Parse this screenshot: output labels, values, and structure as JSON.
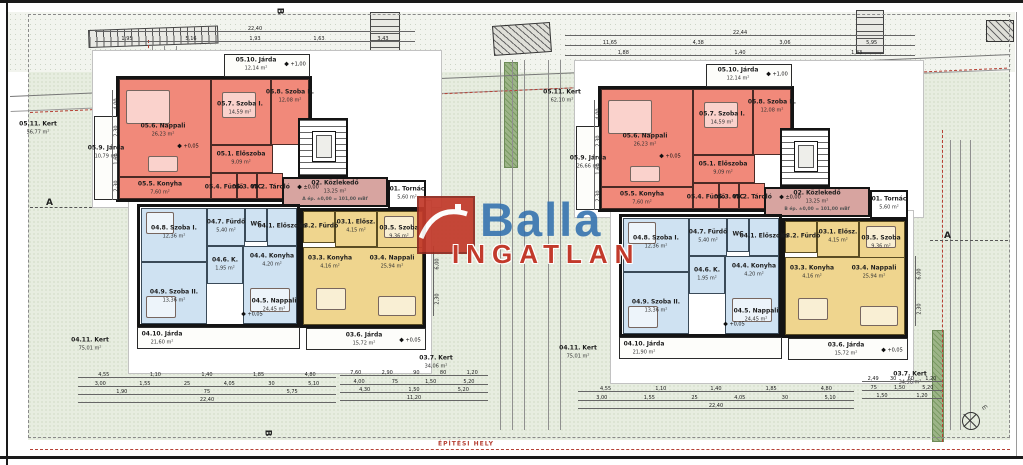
{
  "site_note": "ÉPÍTÉSI HELY",
  "logo": {
    "line1": "Balla",
    "line2": "INGATLAN",
    "blue": "#3270ae",
    "red": "#c23a2b",
    "icon": "house-roof-icon"
  },
  "markers": {
    "section_a": "A",
    "section_b": "B",
    "north": "m"
  },
  "plan": {
    "boxes": [
      {
        "n": "pad-upper",
        "cls": "pad",
        "x": 92,
        "y": 50,
        "w": 350,
        "h": 158
      },
      {
        "n": "pad-lower",
        "cls": "pad",
        "x": 128,
        "y": 200,
        "w": 304,
        "h": 174
      },
      {
        "n": "apartment-05-red",
        "cls": "apt",
        "x": 116,
        "y": 76,
        "w": 196,
        "h": 126
      },
      {
        "n": "room-nappali-05",
        "cls": "red",
        "x": 119,
        "y": 79,
        "w": 92,
        "h": 98
      },
      {
        "n": "room-szoba1-05",
        "cls": "red",
        "x": 211,
        "y": 79,
        "w": 60,
        "h": 66
      },
      {
        "n": "room-szoba2-05",
        "cls": "red",
        "x": 271,
        "y": 79,
        "w": 38,
        "h": 66
      },
      {
        "n": "room-eloszoba-05",
        "cls": "red",
        "x": 211,
        "y": 145,
        "w": 62,
        "h": 28
      },
      {
        "n": "room-furdo-05",
        "cls": "red",
        "x": 211,
        "y": 173,
        "w": 26,
        "h": 26
      },
      {
        "n": "room-wc-05",
        "cls": "red",
        "x": 237,
        "y": 173,
        "w": 20,
        "h": 26
      },
      {
        "n": "room-tarolo-05",
        "cls": "red",
        "x": 257,
        "y": 173,
        "w": 26,
        "h": 26
      },
      {
        "n": "room-konyha-05",
        "cls": "red",
        "x": 119,
        "y": 177,
        "w": 92,
        "h": 22
      },
      {
        "n": "jarda-05-10",
        "cls": "jarda",
        "x": 224,
        "y": 54,
        "w": 86,
        "h": 23
      },
      {
        "n": "jarda-05-9",
        "cls": "jarda",
        "x": 94,
        "y": 116,
        "w": 24,
        "h": 84
      },
      {
        "n": "stairwell",
        "cls": "stair",
        "x": 298,
        "y": 118,
        "w": 50,
        "h": 59
      },
      {
        "n": "elevator",
        "cls": "lift",
        "x": 312,
        "y": 131,
        "w": 24,
        "h": 31
      },
      {
        "n": "corridor-02",
        "cls": "pink",
        "x": 282,
        "y": 177,
        "w": 106,
        "h": 30
      },
      {
        "n": "tornac-01",
        "cls": "white-room",
        "x": 388,
        "y": 180,
        "w": 38,
        "h": 29
      },
      {
        "n": "apartment-04-blue",
        "cls": "apt",
        "x": 137,
        "y": 204,
        "w": 163,
        "h": 123
      },
      {
        "n": "room-szoba1-04",
        "cls": "blue",
        "x": 141,
        "y": 208,
        "w": 66,
        "h": 54
      },
      {
        "n": "room-furdo-04",
        "cls": "blue",
        "x": 207,
        "y": 208,
        "w": 38,
        "h": 38
      },
      {
        "n": "room-wc-04",
        "cls": "blue",
        "x": 245,
        "y": 208,
        "w": 22,
        "h": 34
      },
      {
        "n": "room-eloszoba-04",
        "cls": "blue",
        "x": 267,
        "y": 208,
        "w": 30,
        "h": 38
      },
      {
        "n": "room-kamra-04",
        "cls": "blue",
        "x": 207,
        "y": 246,
        "w": 36,
        "h": 38
      },
      {
        "n": "room-open-04",
        "cls": "blue",
        "x": 243,
        "y": 246,
        "w": 54,
        "h": 78
      },
      {
        "n": "room-szoba2-04",
        "cls": "blue",
        "x": 141,
        "y": 262,
        "w": 66,
        "h": 62
      },
      {
        "n": "jarda-04-10",
        "cls": "jarda",
        "x": 137,
        "y": 327,
        "w": 163,
        "h": 22
      },
      {
        "n": "apartment-03-yellow",
        "cls": "apt",
        "x": 300,
        "y": 208,
        "w": 126,
        "h": 120
      },
      {
        "n": "room-furdo-03",
        "cls": "yellow",
        "x": 303,
        "y": 211,
        "w": 32,
        "h": 32
      },
      {
        "n": "room-eloszoba-03",
        "cls": "yellow",
        "x": 335,
        "y": 211,
        "w": 42,
        "h": 36
      },
      {
        "n": "room-szoba-03",
        "cls": "yellow",
        "x": 377,
        "y": 211,
        "w": 46,
        "h": 48
      },
      {
        "n": "room-open-03",
        "cls": "yellow",
        "x": 303,
        "y": 247,
        "w": 120,
        "h": 78
      },
      {
        "n": "jarda-03-6",
        "cls": "jarda",
        "x": 306,
        "y": 328,
        "w": 120,
        "h": 22
      },
      {
        "n": "sofa",
        "cls": "furn",
        "x": 126,
        "y": 90,
        "w": 44,
        "h": 34
      },
      {
        "n": "bed",
        "cls": "furn",
        "x": 222,
        "y": 92,
        "w": 34,
        "h": 26
      },
      {
        "n": "table",
        "cls": "furn",
        "x": 148,
        "y": 156,
        "w": 30,
        "h": 16
      },
      {
        "n": "bed",
        "cls": "furn",
        "x": 146,
        "y": 212,
        "w": 28,
        "h": 22
      },
      {
        "n": "bed",
        "cls": "furn",
        "x": 146,
        "y": 296,
        "w": 30,
        "h": 22
      },
      {
        "n": "sofa",
        "cls": "furn",
        "x": 250,
        "y": 288,
        "w": 40,
        "h": 24
      },
      {
        "n": "table",
        "cls": "furn",
        "x": 316,
        "y": 288,
        "w": 30,
        "h": 22
      },
      {
        "n": "sofa",
        "cls": "furn",
        "x": 378,
        "y": 296,
        "w": 38,
        "h": 20
      },
      {
        "n": "bed",
        "cls": "furn",
        "x": 384,
        "y": 216,
        "w": 30,
        "h": 22
      }
    ],
    "labels": [
      {
        "code": "05.10.",
        "name": "Járda",
        "area": "12,14 m²",
        "x": 256,
        "y": 64
      },
      {
        "code": "05.11.",
        "name": "Kert",
        "area": "56,77 m²",
        "x": 38,
        "y": 128
      },
      {
        "code": "05.9.",
        "name": "Járda",
        "area": "10,79 m²",
        "x": 106,
        "y": 152
      },
      {
        "code": "05.6.",
        "name": "Nappali",
        "area": "26,23 m²",
        "x": 163,
        "y": 130
      },
      {
        "code": "05.7.",
        "name": "Szoba I.",
        "area": "14,59 m²",
        "x": 240,
        "y": 108
      },
      {
        "code": "05.8.",
        "name": "Szoba II.",
        "area": "12,08 m²",
        "x": 290,
        "y": 96
      },
      {
        "code": "05.1.",
        "name": "Előszoba",
        "area": "9,09 m²",
        "x": 241,
        "y": 158
      },
      {
        "code": "05.5.",
        "name": "Konyha",
        "area": "7,60 m²",
        "x": 160,
        "y": 188
      },
      {
        "code": "05.4.",
        "name": "Fürdő",
        "area": "",
        "x": 224,
        "y": 187
      },
      {
        "code": "05.3.",
        "name": "WC",
        "area": "",
        "x": 247,
        "y": 187
      },
      {
        "code": "05.2.",
        "name": "Tároló",
        "area": "",
        "x": 270,
        "y": 187
      },
      {
        "code": "02.",
        "name": "Közlekedő",
        "area": "13,25 m²",
        "x": 335,
        "y": 187
      },
      {
        "k": "elev",
        "code": "",
        "name": "",
        "area": "",
        "x": 335,
        "y": 200
      },
      {
        "code": "01.",
        "name": "Tornác",
        "area": "5,60 m²",
        "x": 407,
        "y": 193
      },
      {
        "code": "04.8.",
        "name": "Szoba I.",
        "area": "12,36 m²",
        "x": 174,
        "y": 232
      },
      {
        "code": "04.7.",
        "name": "Fürdő",
        "area": "5,40 m²",
        "x": 226,
        "y": 226
      },
      {
        "code": "",
        "name": "WC",
        "area": "",
        "x": 256,
        "y": 224
      },
      {
        "code": "04.1.",
        "name": "Előszoba",
        "area": "",
        "x": 282,
        "y": 226
      },
      {
        "code": "04.6.",
        "name": "K.",
        "area": "1,95 m²",
        "x": 225,
        "y": 264
      },
      {
        "code": "04.4.",
        "name": "Konyha",
        "area": "4,20 m²",
        "x": 272,
        "y": 260
      },
      {
        "code": "04.5.",
        "name": "Nappali",
        "area": "24,45 m²",
        "x": 274,
        "y": 305
      },
      {
        "code": "04.9.",
        "name": "Szoba II.",
        "area": "13,36 m²",
        "x": 174,
        "y": 296
      },
      {
        "code": "04.10.",
        "name": "Járda",
        "area": "21,60 m²",
        "x": 162,
        "y": 338
      },
      {
        "code": "04.11.",
        "name": "Kert",
        "area": "75,01 m²",
        "x": 90,
        "y": 344
      },
      {
        "code": "03.2.",
        "name": "Fürdő",
        "area": "",
        "x": 319,
        "y": 226
      },
      {
        "code": "03.1.",
        "name": "Elősz.",
        "area": "4,15 m²",
        "x": 356,
        "y": 226
      },
      {
        "code": "03.5.",
        "name": "Szoba",
        "area": "9,36 m²",
        "x": 399,
        "y": 232
      },
      {
        "code": "03.3.",
        "name": "Konyha",
        "area": "4,16 m²",
        "x": 330,
        "y": 262
      },
      {
        "code": "03.4.",
        "name": "Nappali",
        "area": "25,94 m²",
        "x": 392,
        "y": 262
      },
      {
        "code": "03.6.",
        "name": "Járda",
        "area": "15,72 m²",
        "x": 364,
        "y": 339
      },
      {
        "code": "03.7.",
        "name": "Kert",
        "area": "34,06 m²",
        "x": 436,
        "y": 362
      }
    ],
    "marks": [
      {
        "x": 188,
        "y": 146,
        "t": "+0,05"
      },
      {
        "x": 295,
        "y": 64,
        "t": "+1,00"
      },
      {
        "x": 308,
        "y": 187,
        "t": "±0,00"
      },
      {
        "x": 252,
        "y": 314,
        "t": "+0,05"
      },
      {
        "x": 410,
        "y": 340,
        "t": "+0,05"
      }
    ]
  },
  "buildings": [
    {
      "id": "A",
      "elev_note": "A ép. ±0,00 = 101,00 mBf",
      "offset": [
        0,
        0
      ],
      "overrides": []
    },
    {
      "id": "B",
      "elev_note": "B ép. ±0,00 = 101,00 mBf",
      "offset": [
        482,
        10
      ],
      "overrides": [
        {
          "code": "05.11.",
          "area": "62,10 m²",
          "x": 562,
          "y": 96,
          "abs": true
        },
        {
          "code": "05.9.",
          "area": "26,66 m²"
        },
        {
          "code": "04.10.",
          "area": "21,90 m²"
        },
        {
          "code": "04.11.",
          "x": 578,
          "y": 352,
          "abs": true
        },
        {
          "code": "03.7.",
          "area": "34,96 m²",
          "x": 910,
          "y": 378,
          "abs": true
        }
      ]
    }
  ],
  "dims": {
    "rows": [
      {
        "x": 95,
        "y": 24,
        "w": 320,
        "nums": [
          "22,40"
        ]
      },
      {
        "x": 95,
        "y": 34,
        "w": 320,
        "nums": [
          "1,95",
          "5,16",
          "1,93",
          "1,63",
          "3,43"
        ]
      },
      {
        "x": 565,
        "y": 28,
        "w": 350,
        "nums": [
          "22,44"
        ]
      },
      {
        "x": 565,
        "y": 38,
        "w": 350,
        "nums": [
          "11,65",
          "4,38",
          "3,06",
          "5,95"
        ]
      },
      {
        "x": 565,
        "y": 48,
        "w": 350,
        "nums": [
          "1,88",
          "1,40",
          "1,83"
        ]
      },
      {
        "x": 78,
        "y": 370,
        "w": 258,
        "nums": [
          "4,55",
          "1,10",
          "1,40",
          "1,85",
          "4,80"
        ]
      },
      {
        "x": 78,
        "y": 379,
        "w": 258,
        "nums": [
          "3,00",
          "1,55",
          "25",
          "4,05",
          "30",
          "5,10"
        ]
      },
      {
        "x": 78,
        "y": 387,
        "w": 258,
        "nums": [
          "1,90",
          "75",
          "5,75"
        ]
      },
      {
        "x": 78,
        "y": 395,
        "w": 258,
        "nums": [
          "22,40"
        ]
      },
      {
        "x": 340,
        "y": 368,
        "w": 148,
        "nums": [
          "7,60",
          "2,90",
          "90",
          "80",
          "1,20"
        ]
      },
      {
        "x": 340,
        "y": 377,
        "w": 148,
        "nums": [
          "4,00",
          "75",
          "1,50",
          "5,20"
        ]
      },
      {
        "x": 340,
        "y": 385,
        "w": 148,
        "nums": [
          "4,30",
          "1,50",
          "5,20"
        ]
      },
      {
        "x": 340,
        "y": 393,
        "w": 148,
        "nums": [
          "11,20"
        ]
      },
      {
        "x": 578,
        "y": 384,
        "w": 276,
        "nums": [
          "4,55",
          "1,10",
          "1,40",
          "1,85",
          "4,80"
        ]
      },
      {
        "x": 578,
        "y": 393,
        "w": 276,
        "nums": [
          "3,00",
          "1,55",
          "25",
          "4,05",
          "30",
          "5,10"
        ]
      },
      {
        "x": 578,
        "y": 401,
        "w": 276,
        "nums": [
          "22,40"
        ]
      },
      {
        "x": 862,
        "y": 374,
        "w": 80,
        "nums": [
          "2,49",
          "30",
          "60",
          "1,20"
        ]
      },
      {
        "x": 862,
        "y": 383,
        "w": 80,
        "nums": [
          "75",
          "1,50",
          "5,20"
        ]
      },
      {
        "x": 862,
        "y": 391,
        "w": 80,
        "nums": [
          "1,50",
          "1,20"
        ]
      }
    ],
    "cols": [
      {
        "x": 112,
        "y": 90,
        "h": 110,
        "nums": [
          "4,00",
          "2,30",
          "1,60",
          "2,30"
        ]
      },
      {
        "x": 433,
        "y": 246,
        "h": 70,
        "nums": [
          "6,00",
          "2,30"
        ]
      },
      {
        "x": 594,
        "y": 100,
        "h": 110,
        "nums": [
          "4,00",
          "2,30",
          "1,60",
          "2,30"
        ]
      },
      {
        "x": 915,
        "y": 256,
        "h": 70,
        "nums": [
          "6,00",
          "2,30"
        ]
      }
    ]
  },
  "site": [
    {
      "n": "garden-base",
      "cls": "site-green",
      "x": 28,
      "y": 44,
      "w": 982,
      "h": 396
    },
    {
      "n": "slope-band",
      "cls": "site-top",
      "x": 8,
      "y": 12,
      "w": 1007,
      "h": 60
    },
    {
      "n": "hedge-center",
      "cls": "hedge",
      "x": 504,
      "y": 62,
      "w": 14,
      "h": 106
    },
    {
      "n": "hedge-right",
      "cls": "hedge",
      "x": 932,
      "y": 330,
      "w": 12,
      "h": 112
    },
    {
      "n": "retaining-wall",
      "cls": "ladder-h",
      "x": 88,
      "y": 30,
      "w": 130,
      "h": 18,
      "rot": -2
    },
    {
      "n": "stairs-outdoor-1",
      "cls": "ladder-v",
      "x": 370,
      "y": 12,
      "w": 30,
      "h": 44
    },
    {
      "n": "stairs-outdoor-2",
      "cls": "ladder-v",
      "x": 856,
      "y": 10,
      "w": 28,
      "h": 44
    },
    {
      "n": "pergola",
      "cls": "hatchbox",
      "x": 492,
      "y": 26,
      "w": 58,
      "h": 30,
      "rot": -4
    },
    {
      "n": "corner-structure",
      "cls": "hatchbox",
      "x": 986,
      "y": 20,
      "w": 28,
      "h": 22
    },
    {
      "n": "slope-lines",
      "cls": "slope-line",
      "x": 10,
      "y": 96,
      "w": 1000,
      "h": 16,
      "rot": -2.4
    },
    {
      "n": "red-boundary-top",
      "cls": "red-dash-h",
      "x": 30,
      "y": 112,
      "w": 978,
      "h": 2,
      "rot": -2.6
    },
    {
      "n": "red-boundary-left",
      "cls": "red-dash-v",
      "x": 148,
      "y": 40,
      "w": 2,
      "h": 120
    },
    {
      "n": "red-boundary-right",
      "cls": "red-dash-v",
      "x": 942,
      "y": 130,
      "w": 2,
      "h": 312
    },
    {
      "n": "survey-line",
      "cls": "gray-line-v",
      "x": 152,
      "y": 46,
      "w": 1,
      "h": 250
    },
    {
      "n": "survey-line",
      "cls": "gray-line-v",
      "x": 164,
      "y": 46,
      "w": 1,
      "h": 250
    },
    {
      "n": "survey-line",
      "cls": "gray-line-v",
      "x": 176,
      "y": 46,
      "w": 1,
      "h": 250
    },
    {
      "n": "survey-line",
      "cls": "gray-line-v",
      "x": 500,
      "y": 60,
      "w": 1,
      "h": 370
    },
    {
      "n": "survey-line",
      "cls": "gray-line-v",
      "x": 512,
      "y": 60,
      "w": 1,
      "h": 370
    },
    {
      "n": "survey-line",
      "cls": "gray-line-v",
      "x": 524,
      "y": 60,
      "w": 1,
      "h": 370
    },
    {
      "n": "survey-line",
      "cls": "gray-line-v",
      "x": 548,
      "y": 60,
      "w": 1,
      "h": 370
    },
    {
      "n": "survey-line",
      "cls": "gray-line-v",
      "x": 560,
      "y": 60,
      "w": 1,
      "h": 370
    },
    {
      "n": "survey-line",
      "cls": "gray-line-v",
      "x": 950,
      "y": 140,
      "w": 1,
      "h": 290
    },
    {
      "n": "survey-line",
      "cls": "gray-line-v",
      "x": 960,
      "y": 140,
      "w": 1,
      "h": 290
    },
    {
      "n": "survey-line",
      "cls": "gray-line-v",
      "x": 970,
      "y": 140,
      "w": 1,
      "h": 290
    },
    {
      "n": "section-line-a-left",
      "cls": "dashdot",
      "x": 30,
      "y": 207,
      "w": 62,
      "h": 2
    },
    {
      "n": "section-line-a-right",
      "cls": "dashdot",
      "x": 930,
      "y": 240,
      "w": 78,
      "h": 2
    },
    {
      "n": "red-boundary-bottom",
      "cls": "red-dash-h",
      "x": 30,
      "y": 449,
      "w": 980,
      "h": 2
    }
  ],
  "sections": [
    {
      "t": "A",
      "x": 46,
      "y": 198
    },
    {
      "t": "A",
      "x": 944,
      "y": 231
    },
    {
      "t": "B",
      "x": 276,
      "y": 6,
      "rot": 90
    },
    {
      "t": "B",
      "x": 264,
      "y": 428,
      "rot": 90
    }
  ]
}
